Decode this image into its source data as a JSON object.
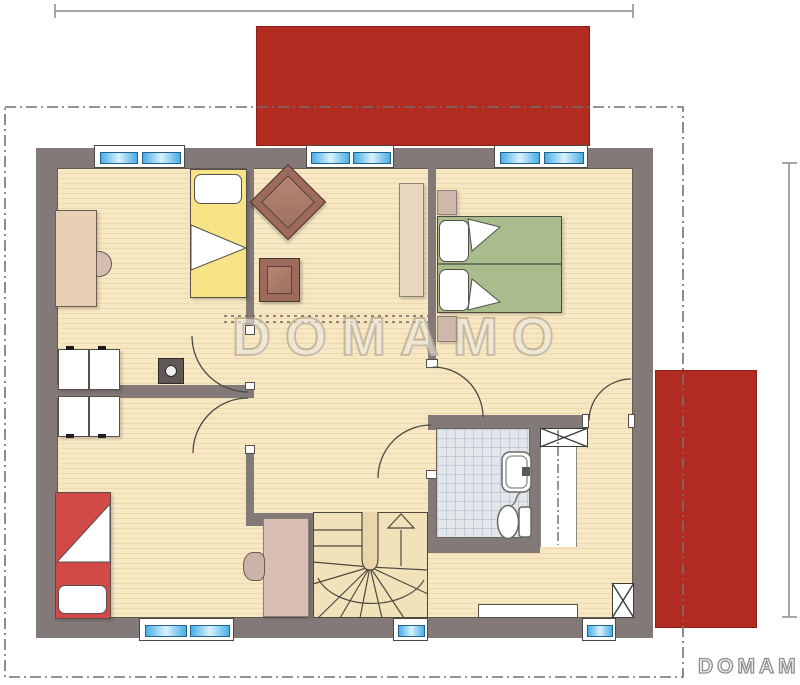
{
  "watermark": {
    "center_text": "DOMAMO",
    "corner_text": "DOMAMO"
  },
  "colors": {
    "roof": "#b12b21",
    "wall": "#837978",
    "floor": "#f7e8c3",
    "stripe": "#ecd9ae",
    "tile": "#e3e7eb",
    "tileline": "#c3cdd5",
    "glass1": "#47aee6",
    "glass2": "#d9f2fd",
    "green": "#a9bc8d",
    "yellow": "#f6e486",
    "red": "#d14a48",
    "brown": "#9c6b5d",
    "brownseat": "#b48673",
    "wood": "#e8cfb5",
    "mauve": "#d8beb4",
    "outline": "#717171",
    "dim": "#8a8a8a"
  }
}
